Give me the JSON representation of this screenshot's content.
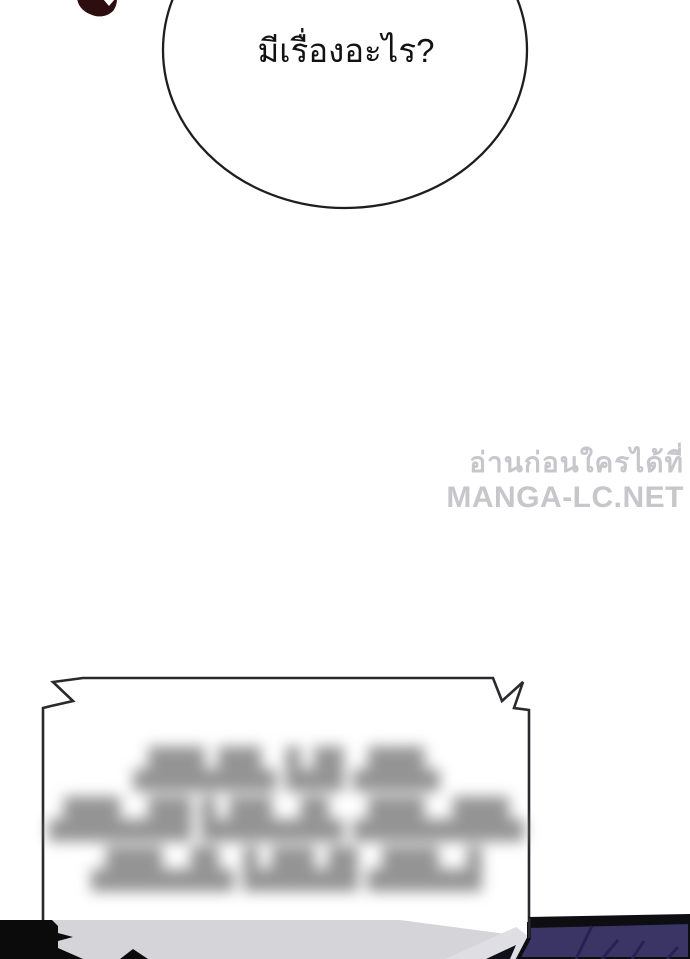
{
  "speech_bubble": {
    "text": "มีเรื่องอะไร?"
  },
  "watermark": {
    "line1": "อ่านก่อนใครได้ที่",
    "line2": "MANGA-LC.NET"
  },
  "narration_box": {
    "blurred_lines": [
      "▟█▙█▙ ▙█ ▟█▙",
      "▟█▙▟█ ▙█▙▟▙ ▟█▙▟█▙",
      "▟█▙▟▙ ▙█▙█ ▟█▙▟"
    ]
  },
  "colors": {
    "outline": "#1e1e1e",
    "box_outline": "#2a2a2e",
    "paper": "#ffffff",
    "band_gray": "#d5d4d8",
    "band_gray_light": "#dfdee2",
    "purple": "#3b3566",
    "purple_crease": "#272350",
    "deep_black": "#0b0b0b",
    "maroon": "#2e0d11",
    "watermark_gray": "#c7c7cb",
    "blur_gray": "#949494"
  }
}
